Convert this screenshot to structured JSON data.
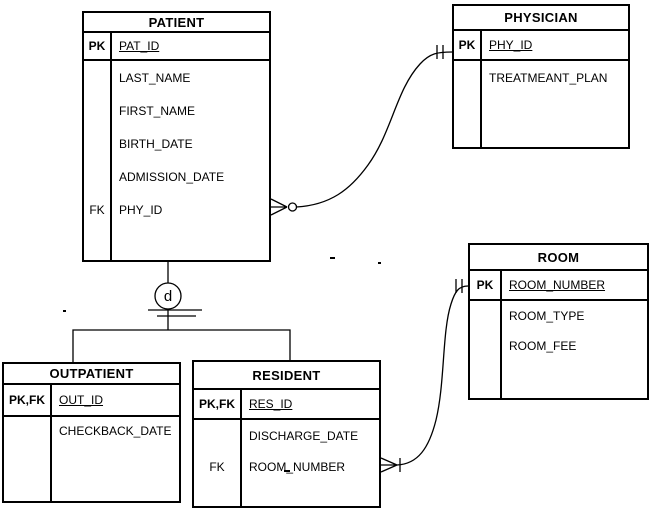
{
  "colors": {
    "line": "#000000",
    "background": "#ffffff",
    "text": "#000000"
  },
  "entities": {
    "patient": {
      "title": "PATIENT",
      "rows": {
        "pk": {
          "key": "PK",
          "attr": "PAT_ID"
        },
        "r1": {
          "key": "",
          "attr": "LAST_NAME"
        },
        "r2": {
          "key": "",
          "attr": "FIRST_NAME"
        },
        "r3": {
          "key": "",
          "attr": "BIRTH_DATE"
        },
        "r4": {
          "key": "",
          "attr": "ADMISSION_DATE"
        },
        "r5": {
          "key": "FK",
          "attr": "PHY_ID"
        }
      }
    },
    "physician": {
      "title": "PHYSICIAN",
      "rows": {
        "pk": {
          "key": "PK",
          "attr": "PHY_ID"
        },
        "r1": {
          "key": "",
          "attr": "TREATMEANT_PLAN"
        }
      }
    },
    "room": {
      "title": "ROOM",
      "rows": {
        "pk": {
          "key": "PK",
          "attr": "ROOM_NUMBER"
        },
        "r1": {
          "key": "",
          "attr": "ROOM_TYPE"
        },
        "r2": {
          "key": "",
          "attr": "ROOM_FEE"
        }
      }
    },
    "outpatient": {
      "title": "OUTPATIENT",
      "rows": {
        "pk": {
          "key": "PK,FK",
          "attr": "OUT_ID"
        },
        "r1": {
          "key": "",
          "attr": "CHECKBACK_DATE"
        }
      }
    },
    "resident": {
      "title": "RESIDENT",
      "rows": {
        "pk": {
          "key": "PK,FK",
          "attr": "RES_ID"
        },
        "r1": {
          "key": "",
          "attr": "DISCHARGE_DATE"
        },
        "r2": {
          "key": "FK",
          "attr": "ROOM_NUMBER"
        }
      }
    }
  },
  "subtype": {
    "label": "d"
  },
  "notation": {
    "patient_side": "zero-or-many-crow-foot",
    "physician_side": "one-and-only-one-double-tick",
    "resident_side": "one-or-many-crow-foot",
    "room_side": "one-and-only-one-double-tick"
  }
}
